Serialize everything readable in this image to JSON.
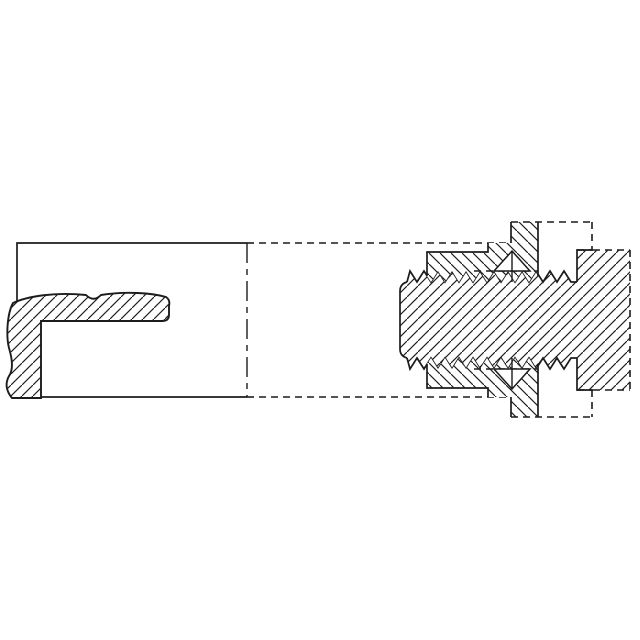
{
  "figure": {
    "title": "Sectional technical drawing of a tube coupling with threaded stud, union nut and deformed seal sleeve",
    "background_color": "#ffffff",
    "line_color": "#1c1c1c",
    "line_styles": {
      "solid_outline": "continuous",
      "hidden_phantom": "short dashes",
      "break_centerline": "long-dash short-dash"
    },
    "parts": [
      {
        "id": "tube-housing",
        "label": "outer tube shown in outline, broken at centerline"
      },
      {
        "id": "seal-sleeve",
        "label": "L-shaped sectioned seal sleeve with wavy deformed edges"
      },
      {
        "id": "threaded-stud",
        "label": "externally threaded stud with rounded left end"
      },
      {
        "id": "fitting-head",
        "label": "fitting head with phantom (dashed) outer edges"
      },
      {
        "id": "union-nut-upper",
        "label": "upper half of union nut engaging the threads"
      },
      {
        "id": "union-nut-lower",
        "label": "lower half of union nut engaging the threads"
      },
      {
        "id": "phantom-hex-corner-upper",
        "label": "dashed phantom outline of upper hex corner recess"
      },
      {
        "id": "phantom-hex-corner-lower",
        "label": "dashed phantom outline of lower hex corner recess"
      },
      {
        "id": "cone-marker-upper",
        "label": "small triangular cone detail above thread"
      },
      {
        "id": "cone-marker-lower",
        "label": "small triangular cone detail below thread"
      }
    ]
  }
}
